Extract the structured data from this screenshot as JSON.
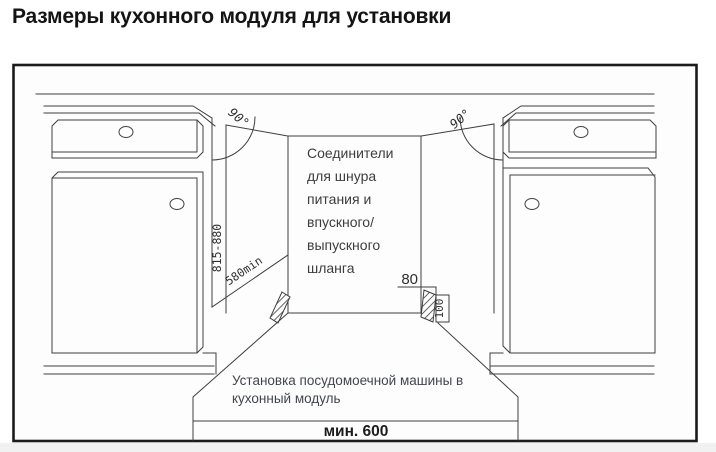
{
  "title": "Размеры кухонного модуля для установки",
  "diagram": {
    "angle_left_label": "90°",
    "angle_right_label": "90°",
    "cabinet_height_range": "815-880",
    "niche_depth_min": "580min",
    "hose_offset_top": "80",
    "hose_offset_side": "100",
    "niche_width_min": "мин. 600",
    "connector_note_lines": [
      "Соединители",
      "для шнура",
      "питания и",
      "впускного/",
      "выпускного",
      "шланга"
    ],
    "install_note_lines": [
      "Установка посудомоечной машины в",
      "кухонный модуль"
    ]
  },
  "colors": {
    "frame": "#1b1b1b",
    "line": "#3f3f3f",
    "text": "#3d3d3d",
    "title": "#141414",
    "background": "#ffffff"
  }
}
